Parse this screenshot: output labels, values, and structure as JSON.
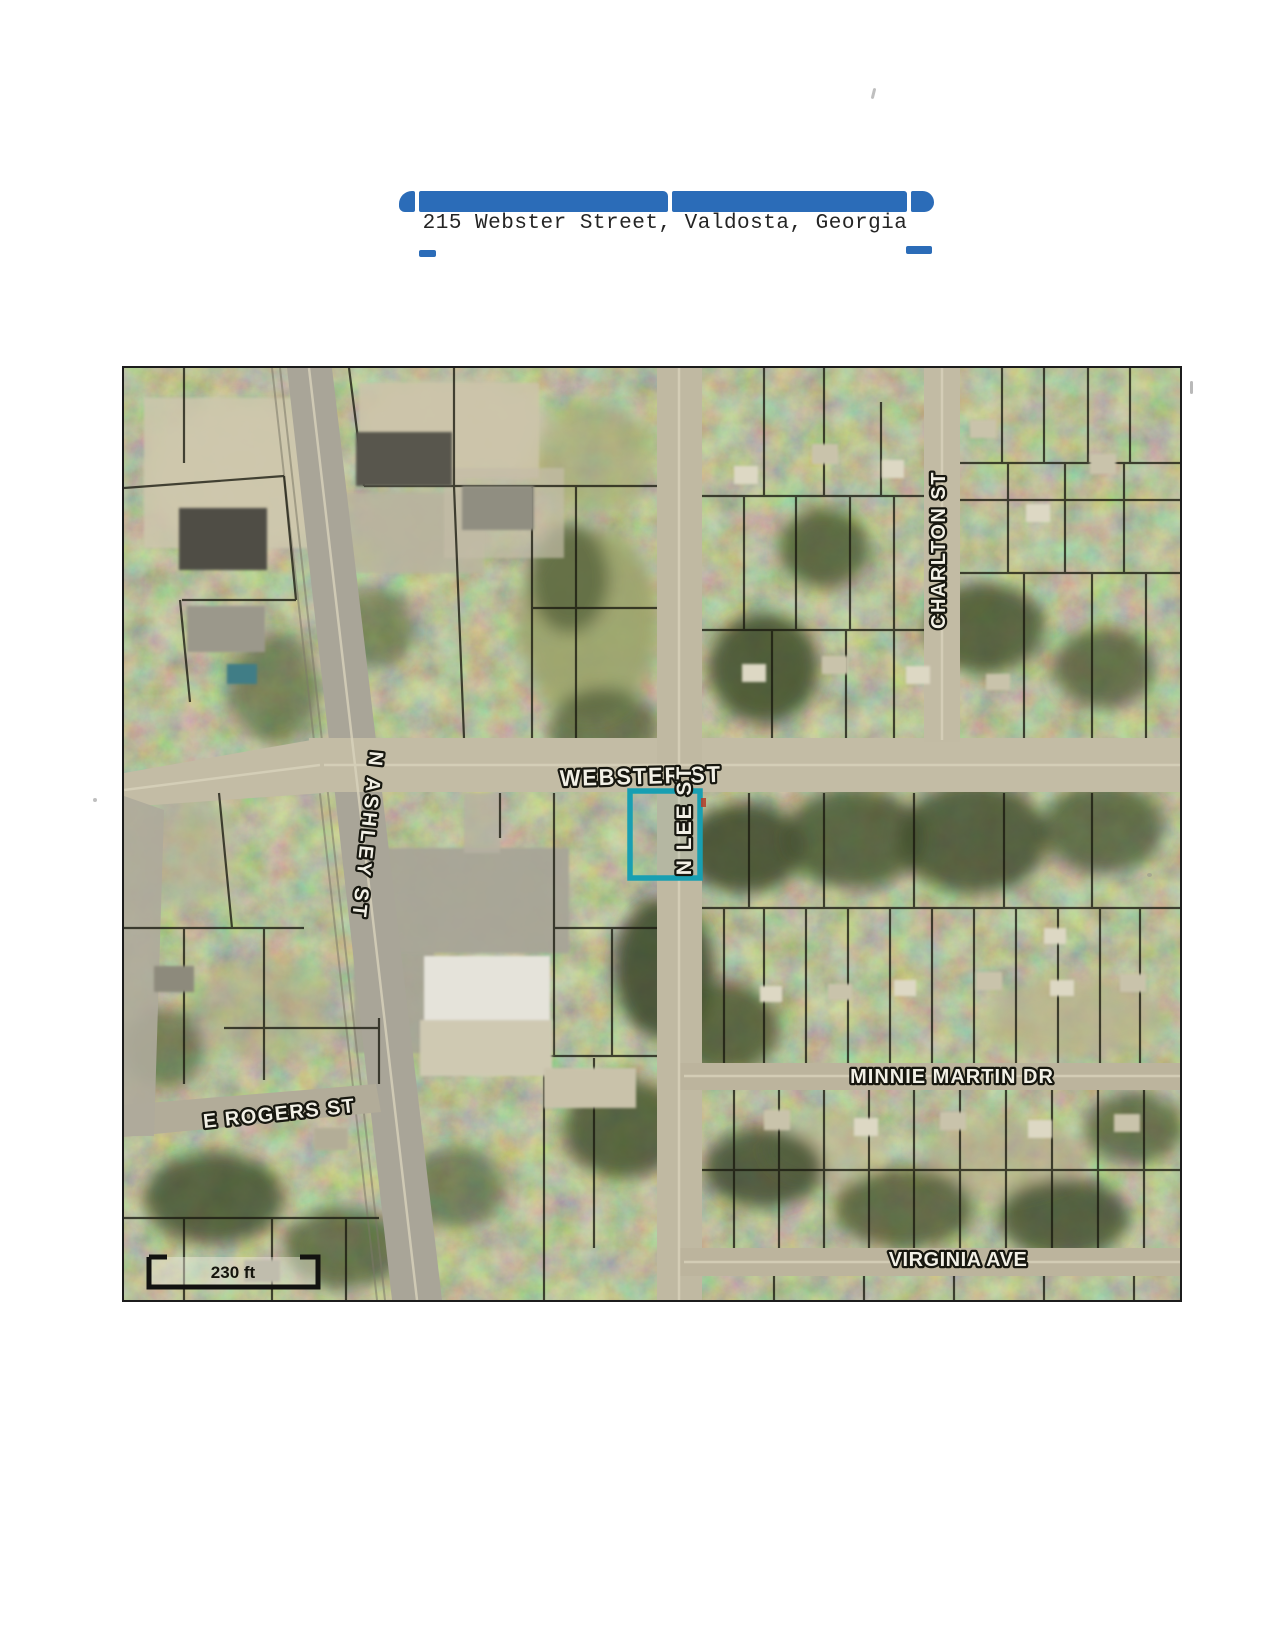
{
  "header": {
    "title": "215 Webster Street, Valdosta, Georgia"
  },
  "map": {
    "streets": {
      "webster": "WEBSTER ST",
      "n_lee": "N LEE ST",
      "n_ashley": "N ASHLEY ST",
      "charlton": "CHARLTON ST",
      "minnie_martin": "MINNIE MARTIN DR",
      "e_rogers": "E ROGERS ST",
      "virginia": "VIRGINIA AVE"
    },
    "scale_label": "230 ft",
    "highlight_color": "#189fb2",
    "accent_blue": "#2b6cb8"
  }
}
